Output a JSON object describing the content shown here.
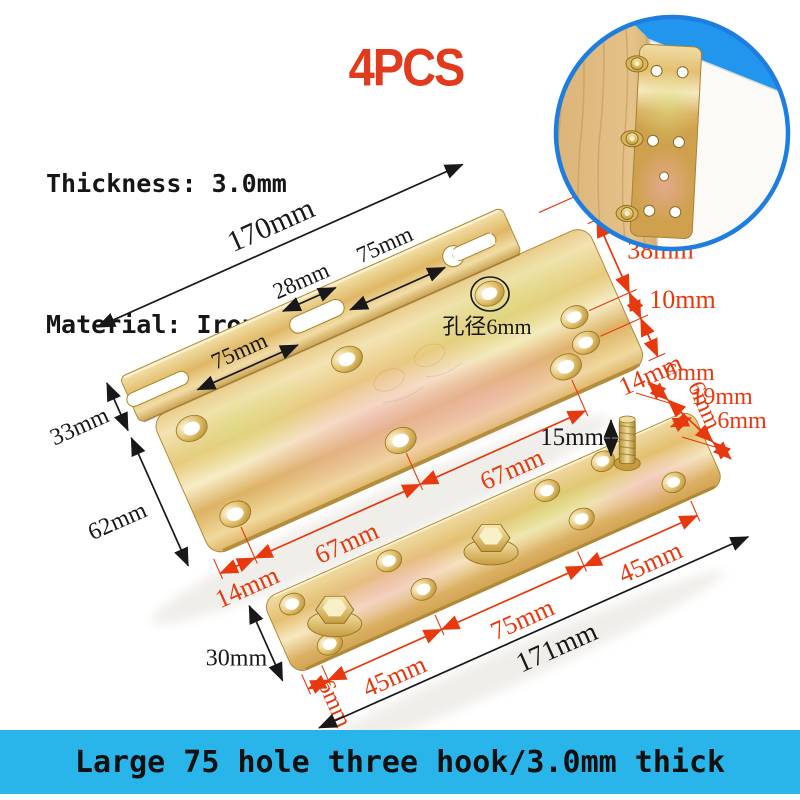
{
  "header": {
    "thickness": "Thickness: 3.0mm",
    "material": "Material: Iron",
    "quantity": "4PCS"
  },
  "banner": {
    "text": "Large 75 hole three hook/3.0mm thick"
  },
  "colors": {
    "accent_red": "#e23a1c",
    "dimension_red": "#e8380d",
    "dimension_black": "#181818",
    "banner_bg": "#2ab5ea",
    "ring_blue": "#1d7ee0"
  },
  "main_bracket": {
    "length_total": "170mm",
    "slot_length": "28mm",
    "segment_left": "75mm",
    "segment_right": "75mm",
    "flange_height": "33mm",
    "plate_depth": "62mm",
    "hole_diameter_label": "孔径6mm",
    "edge_offset": "12mm",
    "right_span_1": "38mm",
    "right_span_2": "10mm",
    "bottom_right_margin": "14mm",
    "bottom_left_margin": "14mm",
    "bottom_span_1": "67mm",
    "bottom_span_2": "67mm"
  },
  "flat_bar": {
    "top_margin": "6mm",
    "row_span": "19mm",
    "bottom_margin": "6mm",
    "end_margin_right": "6mm",
    "end_margin_left": "6mm",
    "stud_height": "15mm",
    "span_left": "45mm",
    "span_center": "75mm",
    "span_right": "45mm",
    "length_total": "171mm",
    "width": "30mm"
  }
}
